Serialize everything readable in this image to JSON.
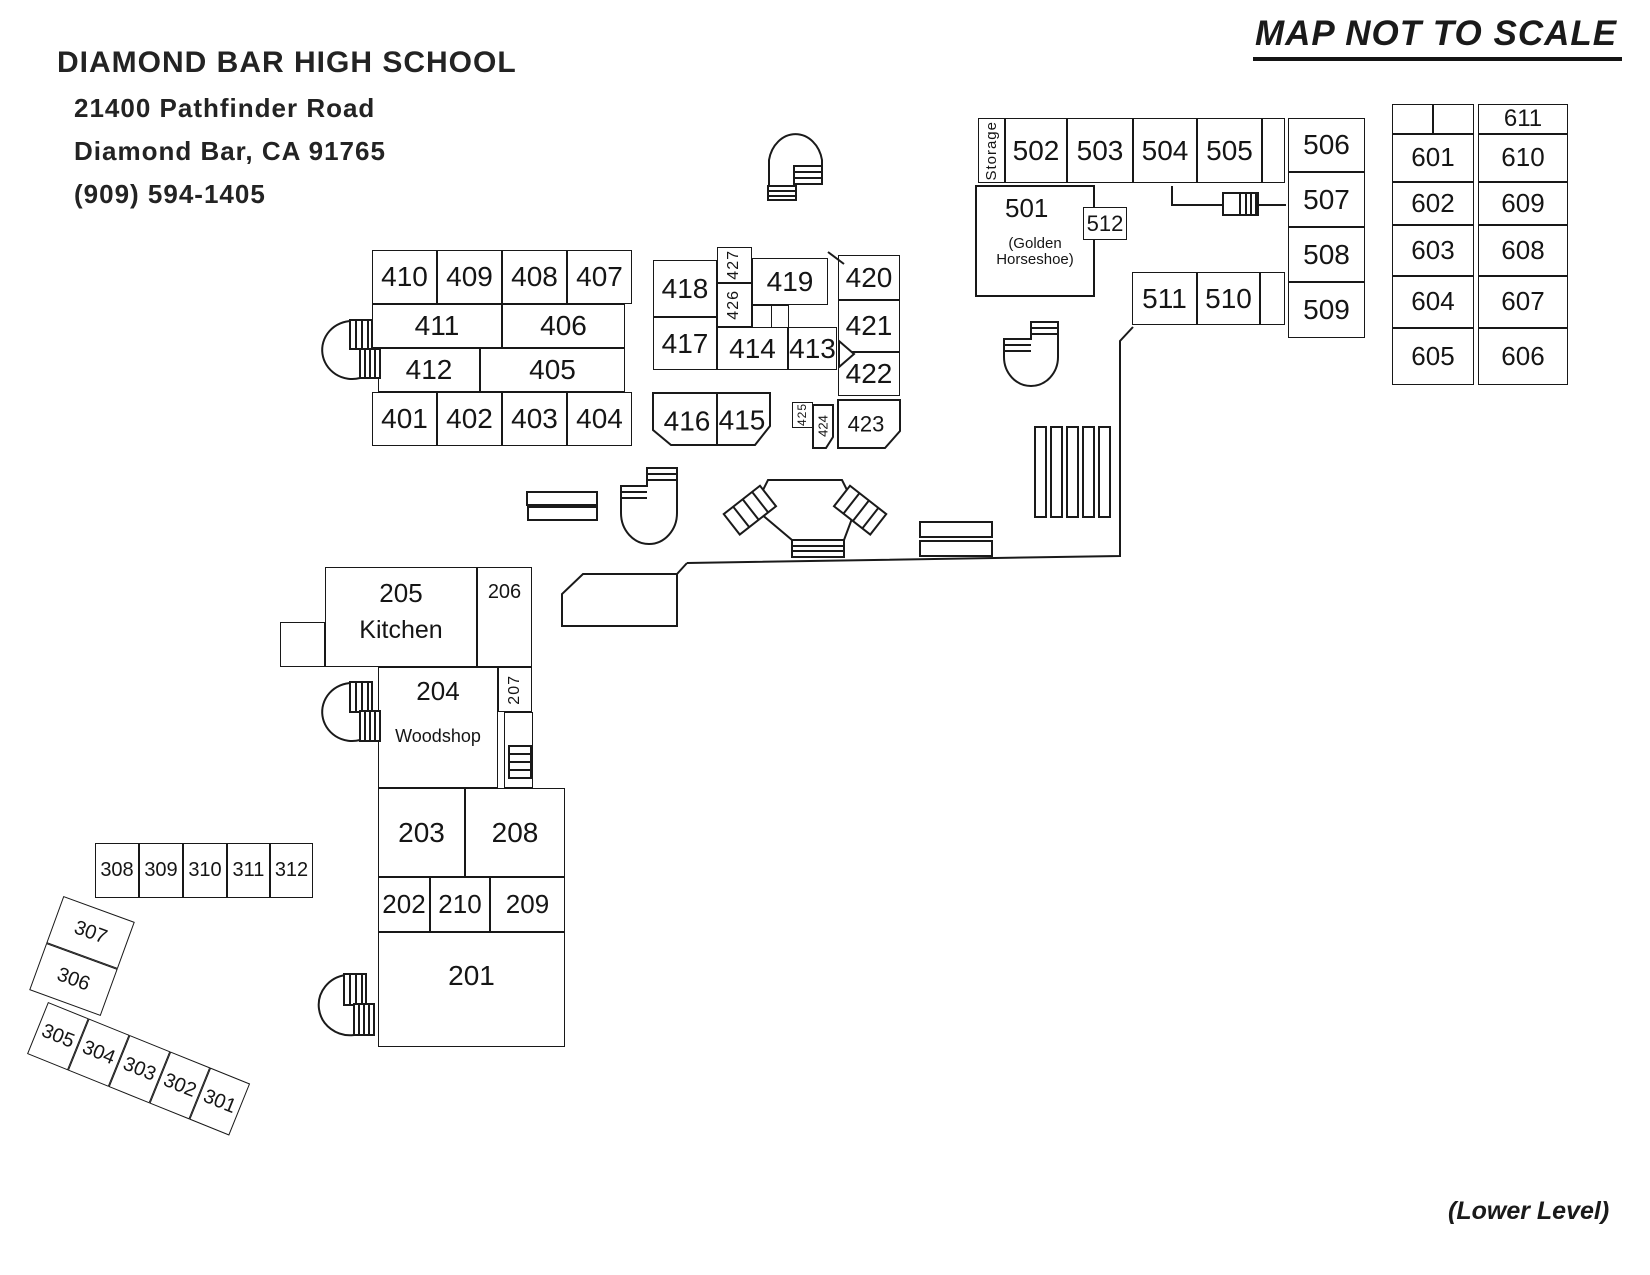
{
  "map": {
    "school": {
      "name": "DIAMOND BAR HIGH SCHOOL",
      "address1": "21400 Pathfinder Road",
      "address2": "Diamond Bar, CA 91765",
      "phone": "(909) 594-1405"
    },
    "notes": {
      "scale": "MAP NOT TO SCALE",
      "level": "(Lower Level)"
    },
    "rooms": {
      "r201": "201",
      "r202": "202",
      "r203": "203",
      "r204": "204",
      "r205": "205",
      "r206": "206",
      "r207": "207",
      "r208": "208",
      "r209": "209",
      "r210": "210",
      "kitchen": "Kitchen",
      "woodshop": "Woodshop",
      "r301": "301",
      "r302": "302",
      "r303": "303",
      "r304": "304",
      "r305": "305",
      "r306": "306",
      "r307": "307",
      "r308": "308",
      "r309": "309",
      "r310": "310",
      "r311": "311",
      "r312": "312",
      "r401": "401",
      "r402": "402",
      "r403": "403",
      "r404": "404",
      "r405": "405",
      "r406": "406",
      "r407": "407",
      "r408": "408",
      "r409": "409",
      "r410": "410",
      "r411": "411",
      "r412": "412",
      "r413": "413",
      "r414": "414",
      "r415": "415",
      "r416": "416",
      "r417": "417",
      "r418": "418",
      "r419": "419",
      "r420": "420",
      "r421": "421",
      "r422": "422",
      "r423": "423",
      "r424": "424",
      "r425": "425",
      "r426": "426",
      "r427": "427",
      "r501": "501",
      "r502": "502",
      "r503": "503",
      "r504": "504",
      "r505": "505",
      "r506": "506",
      "r507": "507",
      "r508": "508",
      "r509": "509",
      "r510": "510",
      "r511": "511",
      "r512": "512",
      "storage": "Storage",
      "golden": "(Golden Horseshoe)",
      "r601": "601",
      "r602": "602",
      "r603": "603",
      "r604": "604",
      "r605": "605",
      "r606": "606",
      "r607": "607",
      "r608": "608",
      "r609": "609",
      "r610": "610",
      "r611": "611"
    }
  }
}
